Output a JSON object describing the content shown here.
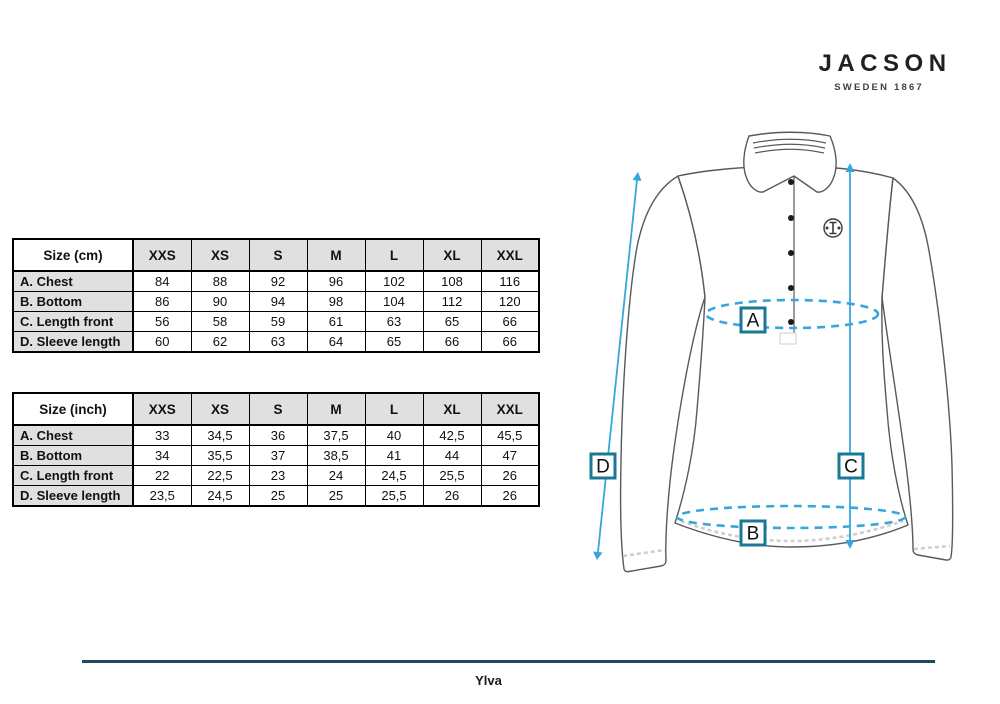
{
  "brand": {
    "name": "JACSON",
    "tagline": "SWEDEN 1867"
  },
  "product": {
    "name": "Ylva"
  },
  "measure_labels": {
    "a": "A",
    "b": "B",
    "c": "C",
    "d": "D"
  },
  "tables": [
    {
      "id": "cm",
      "header": [
        "Size (cm)",
        "XXS",
        "XS",
        "S",
        "M",
        "L",
        "XL",
        "XXL"
      ],
      "rows": [
        {
          "label": "A. Chest",
          "values": [
            "84",
            "88",
            "92",
            "96",
            "102",
            "108",
            "116"
          ]
        },
        {
          "label": "B. Bottom",
          "values": [
            "86",
            "90",
            "94",
            "98",
            "104",
            "112",
            "120"
          ]
        },
        {
          "label": "C. Length front",
          "values": [
            "56",
            "58",
            "59",
            "61",
            "63",
            "65",
            "66"
          ]
        },
        {
          "label": "D. Sleeve length",
          "values": [
            "60",
            "62",
            "63",
            "64",
            "65",
            "66",
            "66"
          ]
        }
      ]
    },
    {
      "id": "inch",
      "header": [
        "Size (inch)",
        "XXS",
        "XS",
        "S",
        "M",
        "L",
        "XL",
        "XXL"
      ],
      "rows": [
        {
          "label": "A. Chest",
          "values": [
            "33",
            "34,5",
            "36",
            "37,5",
            "40",
            "42,5",
            "45,5"
          ]
        },
        {
          "label": "B. Bottom",
          "values": [
            "34",
            "35,5",
            "37",
            "38,5",
            "41",
            "44",
            "47"
          ]
        },
        {
          "label": "C. Length front",
          "values": [
            "22",
            "22,5",
            "23",
            "24",
            "24,5",
            "25,5",
            "26"
          ]
        },
        {
          "label": "D. Sleeve length",
          "values": [
            "23,5",
            "24,5",
            "25",
            "25",
            "25,5",
            "26",
            "26"
          ]
        }
      ]
    }
  ],
  "colors": {
    "accent_blue": "#35a7dd",
    "box_border": "#1a7796",
    "footer_line": "#1d4a5e",
    "outline_gray": "#58595b",
    "table_gray": "#e0e0e0"
  }
}
